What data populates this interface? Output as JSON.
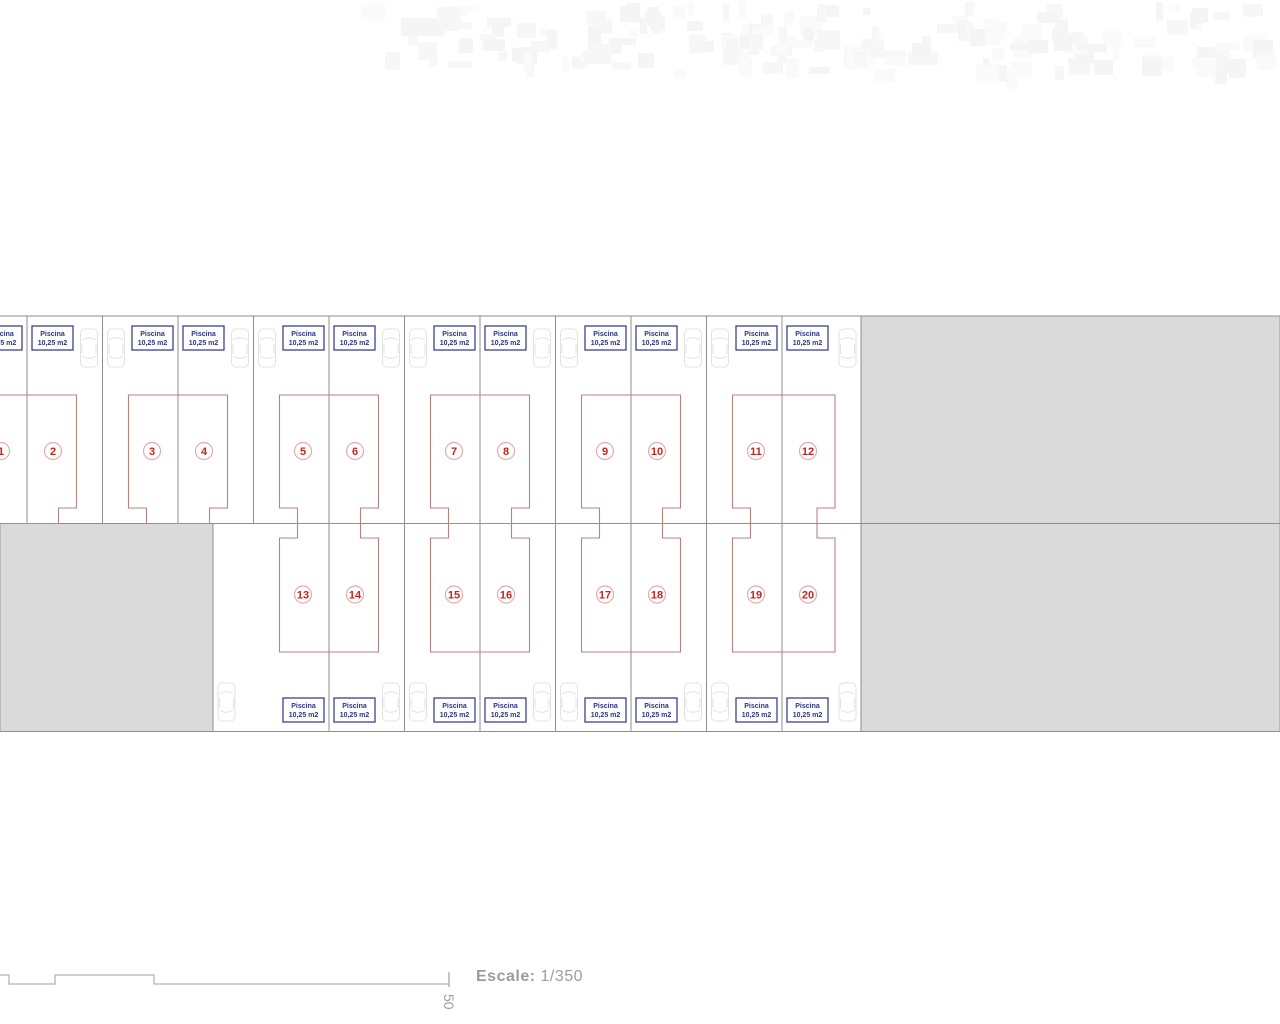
{
  "document": {
    "background": "#ffffff"
  },
  "site_plan": {
    "pool_label": {
      "line1": "Piscina",
      "line2": "10,25 m2"
    },
    "top_row_plot_numbers": [
      "1",
      "2",
      "3",
      "4",
      "5",
      "6",
      "7",
      "8",
      "9",
      "10",
      "11",
      "12"
    ],
    "bottom_row_plot_numbers": [
      "13",
      "14",
      "15",
      "16",
      "17",
      "18",
      "19",
      "20"
    ],
    "colors": {
      "plot_boundary": "#8e8e8e",
      "house_footprint": "#bc8280",
      "plot_number": "#c1261d",
      "plot_number_circle": "#e5aba9",
      "pool_box": "#2c3484",
      "common_area_fill": "#dadada",
      "common_area_edge": "#9a9a9a",
      "car_outline": "#e2e2e2",
      "scale_line": "#b3b3b3",
      "noise": "#f7f7f7"
    }
  },
  "scale_bar": {
    "label": "Escale:",
    "value": "1/350",
    "tick_label": "50"
  }
}
